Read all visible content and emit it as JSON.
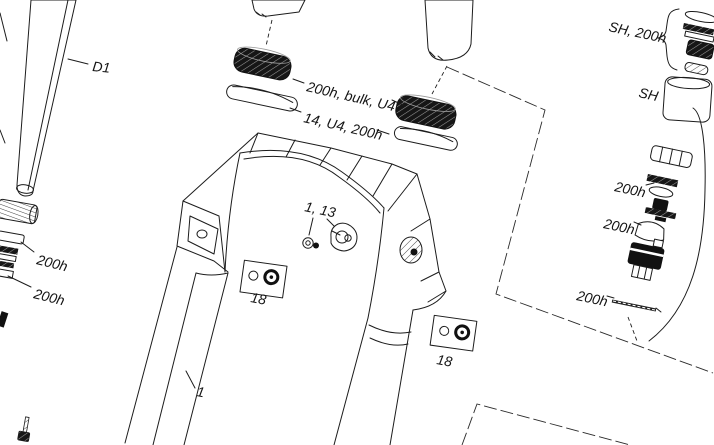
{
  "diagram_title": "Suspension fork exploded service parts diagram",
  "callouts": {
    "damper_shaft": "D1",
    "dust_seal_kit": "200h, bulk, U4",
    "foam_ring_kit": "14, U4, 200h",
    "seal_head_group": "SH, 200h",
    "seal_head": "SH",
    "left_upper_service": "200h",
    "left_lower_service": "200h",
    "right_seal_stack_service": "200h",
    "right_piston_service": "200h",
    "right_shaft_service": "200h",
    "bolt_and_cable_guide": "1, 13",
    "fender_bolt_left": "18",
    "fender_bolt_right": "18",
    "lower_leg_assembly": "1"
  },
  "colors": {
    "line": "#1c1c1c",
    "background": "#ffffff",
    "dark_part": "#111111"
  }
}
